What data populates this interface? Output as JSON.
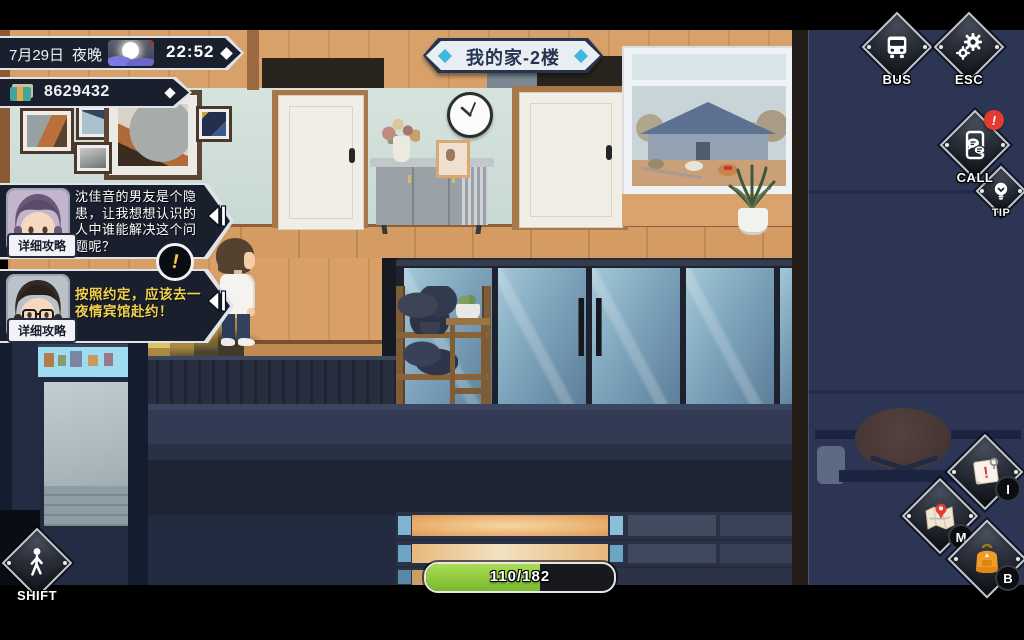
{
  "hud": {
    "datetime": {
      "date": "7月29日",
      "period": "夜晚",
      "time": "22:52"
    },
    "money": "8629432",
    "location": "我的家-2楼",
    "quests": [
      {
        "text": "沈佳音的男友是个隐患，让我想想认识的人中谁能解决这个问题呢？",
        "guide_button": "详细攻略"
      },
      {
        "text": "按照约定，应该去一夜情宾馆赴约！",
        "guide_button": "详细攻略"
      }
    ],
    "alert_badge": "!",
    "top_right_buttons": [
      {
        "id": "bus",
        "label": "BUS"
      },
      {
        "id": "esc",
        "label": "ESC"
      },
      {
        "id": "call",
        "label": "CALL",
        "badge": "!"
      },
      {
        "id": "tip",
        "label": "TIP"
      }
    ],
    "bottom_right_buttons": [
      {
        "id": "inventory-note",
        "badge": "I"
      },
      {
        "id": "map",
        "badge": "M"
      },
      {
        "id": "bag",
        "badge": "B"
      }
    ],
    "shift_label": "SHIFT",
    "progress": {
      "label": "110/182",
      "value": 110,
      "max": 182
    }
  },
  "colors": {
    "banner_navy": "#11172a",
    "accent_cyan": "#3fb6dc",
    "quest_highlight_yellow": "#f0d24e",
    "progress_green": "#8dc63f",
    "alert_red": "#e23b30",
    "wall_mint": "#cfded8",
    "floor_wood": "#d49c62",
    "night_navy": "#2c3654"
  }
}
